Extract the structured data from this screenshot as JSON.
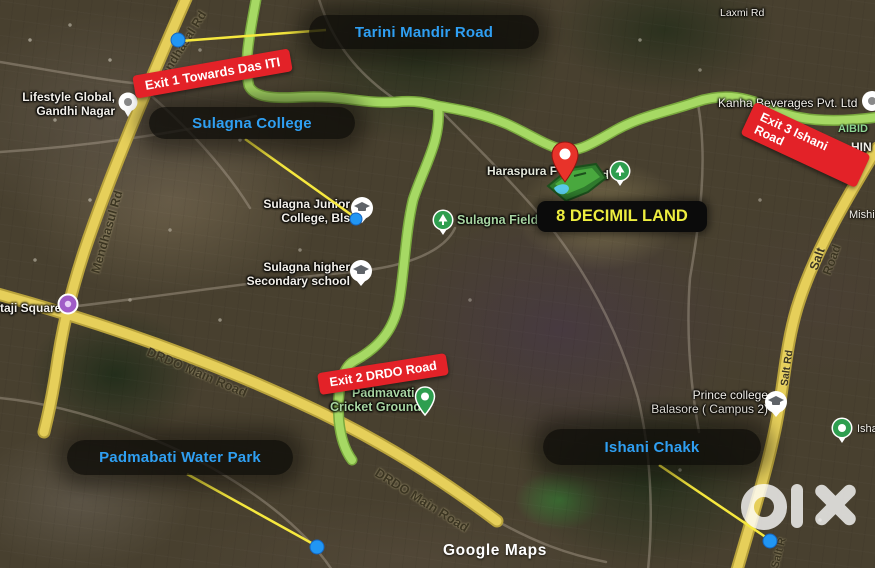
{
  "map": {
    "property_label": "8 DECIMIL LAND",
    "annotations": {
      "tarini": "Tarini Mandir Road",
      "sulagna_college": "Sulagna College",
      "padmabati": "Padmabati Water Park",
      "ishani": "Ishani Chakk"
    },
    "exits": {
      "exit1": "Exit 1 Towards Das ITI",
      "exit2": "Exit 2 DRDO Road",
      "exit3": "Exit 3 Ishani Road"
    },
    "roads": {
      "mendhasal_top": "Mendhasal Rd",
      "mendhasul_mid": "Mendhasul Rd",
      "drdo_1": "DRDO Main Road",
      "drdo_2": "DRDO Main Road",
      "salt_road": "Salt Road",
      "salt_rd_small": "Salt Rd",
      "salt_bottom": "Salt R",
      "laxmi": "Laxmi Rd"
    },
    "pois": {
      "lifestyle": {
        "line1": "Lifestyle Global,",
        "line2": "Gandhi Nagar"
      },
      "netaji": "taji Square",
      "junior_college": {
        "line1": "Sulagna Junior",
        "line2": "College, Bls"
      },
      "secondary_school": {
        "line1": "Sulagna higher",
        "line2": "Secondary school"
      },
      "sulagna_field": "Sulagna Field",
      "haraspura_left": "Haraspura F",
      "haraspura_right": "Ind",
      "kanha": "Kanha Beverages Pvt. Ltd",
      "cricket": {
        "line1": "Padmavati",
        "line2": "Cricket Ground"
      },
      "prince": {
        "line1": "Prince college",
        "line2": "Balasore ( Campus 2)"
      },
      "edge_aibid": "AIBID",
      "edge_hin": "HIN",
      "edge_mishi": "Mishi",
      "edge_isha": "Isha"
    },
    "watermarks": {
      "olx": "OLX",
      "google_maps": "Google Maps"
    },
    "colors": {
      "route_green": "#a6d964",
      "road_yellow": "#e6cf5a",
      "annotation_blue": "#2f9ff2",
      "exit_red": "#e32228",
      "property_yellow": "#eded3f",
      "pin_red": "#e8332a"
    }
  }
}
